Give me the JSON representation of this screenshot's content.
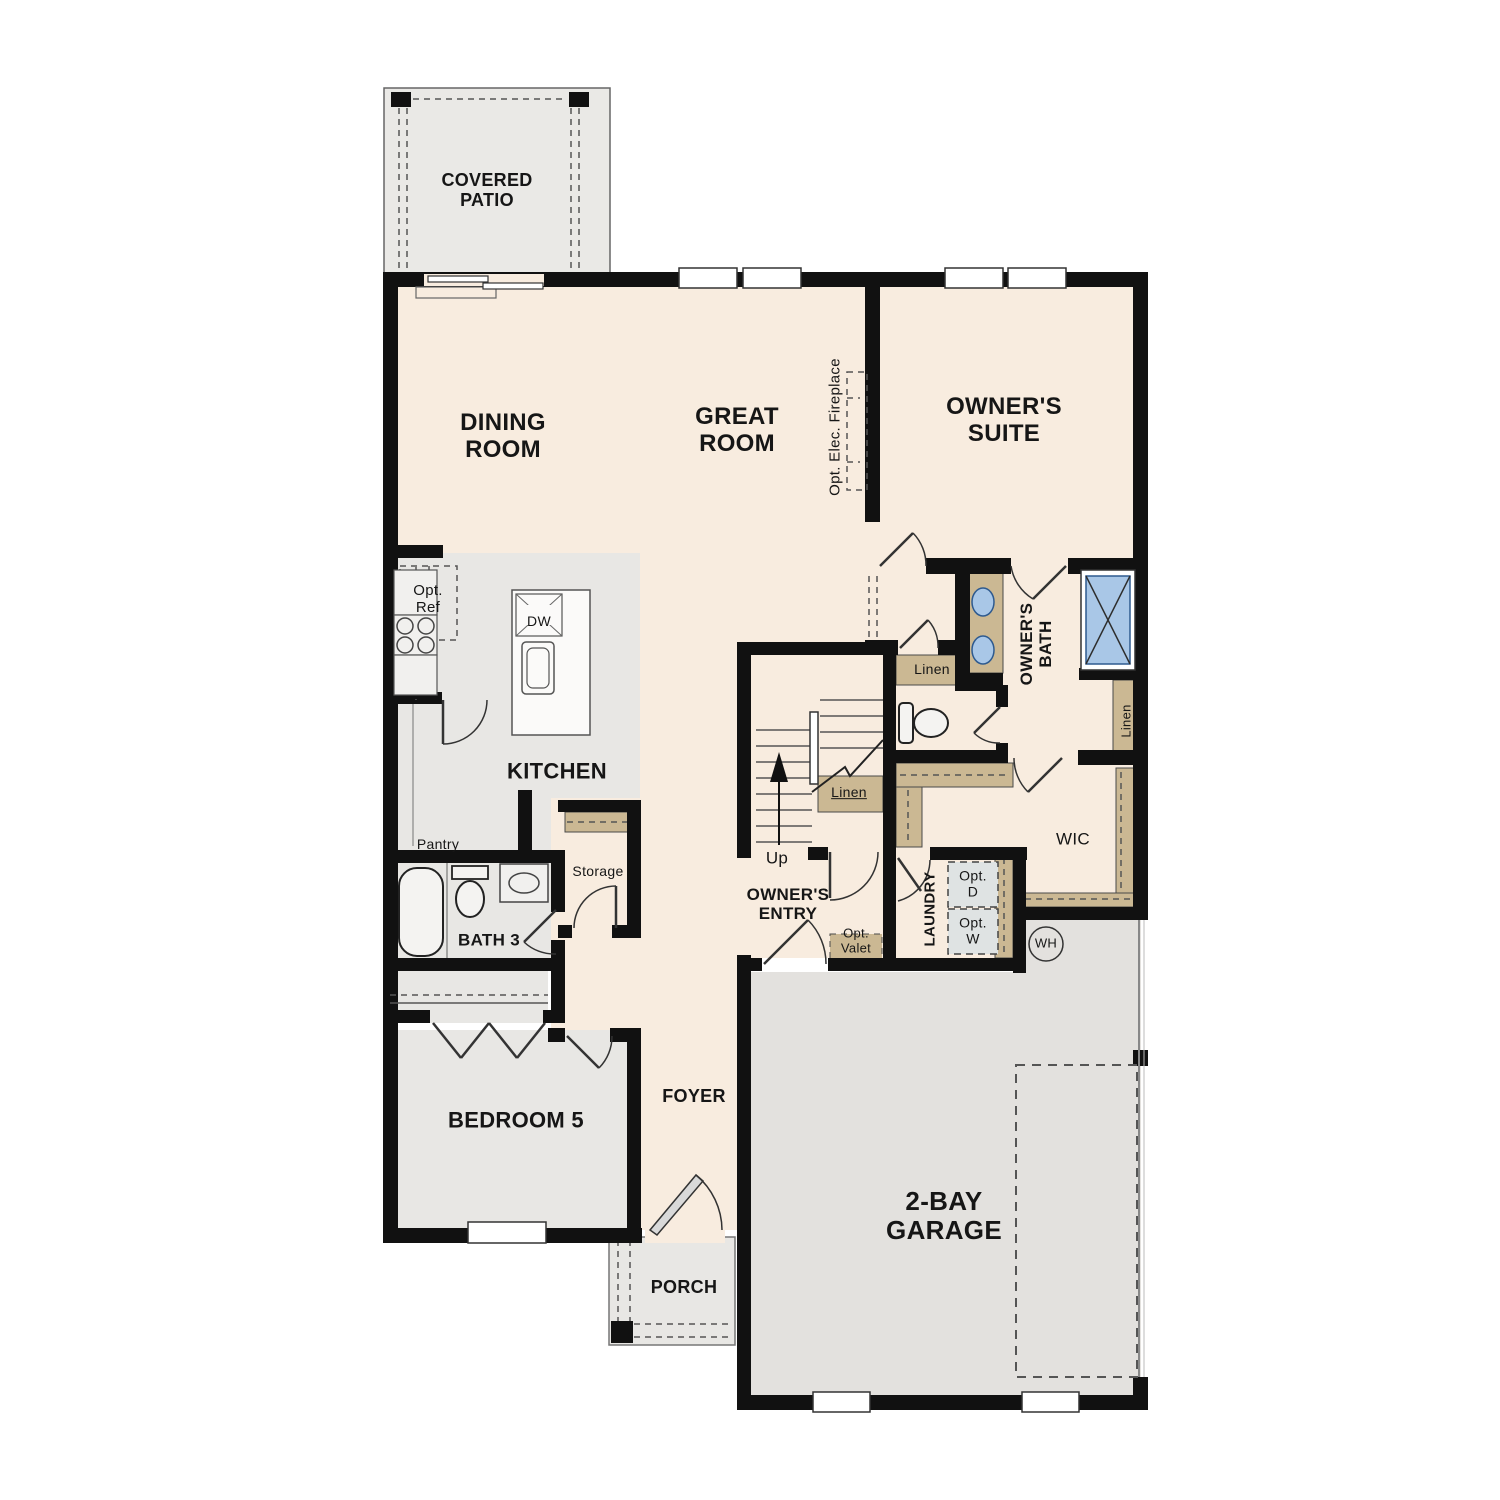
{
  "plan": {
    "type": "residential-floor-plan",
    "floor": "first-floor"
  },
  "colors": {
    "cream": "#f8ecdf",
    "gray": "#e8e7e4",
    "garage": "#e3e1de",
    "patio": "#eae9e6",
    "tan": "#cbb893",
    "blue": "#a9c7e7",
    "opt": "#dfe3e3",
    "wall": "#111111",
    "door_leaf": "#d9d9d9"
  },
  "labels": {
    "covered_patio": {
      "text": "COVERED\nPATIO"
    },
    "dining": {
      "text": "DINING\nROOM"
    },
    "great": {
      "text": "GREAT\nROOM"
    },
    "owners_suite": {
      "text": "OWNER'S\nSUITE"
    },
    "fireplace": {
      "text": "Opt. Elec. Fireplace"
    },
    "opt_ref": {
      "text": "Opt.\nRef"
    },
    "dw": {
      "text": "DW"
    },
    "kitchen": {
      "text": "KITCHEN"
    },
    "pantry": {
      "text": "Pantry"
    },
    "storage": {
      "text": "Storage"
    },
    "bath3": {
      "text": "BATH 3"
    },
    "linen_stairs": {
      "text": "Linen"
    },
    "linen_vestibule": {
      "text": "Linen"
    },
    "linen_right": {
      "text": "Linen"
    },
    "owners_bath": {
      "text": "OWNER'S\nBATH"
    },
    "wic": {
      "text": "WIC"
    },
    "up": {
      "text": "Up"
    },
    "owners_entry": {
      "text": "OWNER'S\nENTRY"
    },
    "opt_valet": {
      "text": "Opt.\nValet"
    },
    "laundry": {
      "text": "LAUNDRY"
    },
    "opt_d": {
      "text": "Opt.\nD"
    },
    "opt_w": {
      "text": "Opt.\nW"
    },
    "wh": {
      "text": "WH"
    },
    "bedroom5": {
      "text": "BEDROOM 5"
    },
    "foyer": {
      "text": "FOYER"
    },
    "porch": {
      "text": "PORCH"
    },
    "garage": {
      "text": "2-BAY\nGARAGE"
    }
  }
}
